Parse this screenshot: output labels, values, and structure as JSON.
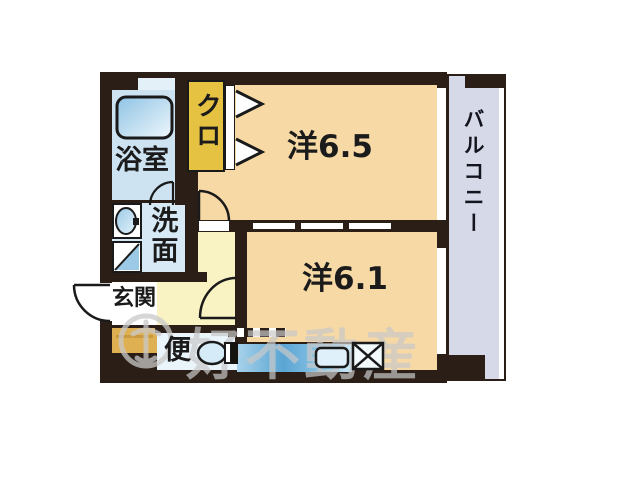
{
  "floorplan": {
    "rooms": {
      "bath": {
        "label": "浴室"
      },
      "closet": {
        "label": "クロ"
      },
      "western_65": {
        "label": "洋6.5"
      },
      "western_61": {
        "label": "洋6.1"
      },
      "washroom": {
        "label": "洗面"
      },
      "entrance": {
        "label": "玄関"
      },
      "toilet": {
        "label": "便"
      },
      "balcony": {
        "label": "バルコニー"
      }
    },
    "watermark": {
      "text": "好不動産",
      "logo": "realtor-logo-icon"
    },
    "fixtures": {
      "bathtub": "bathtub-icon",
      "wash_basin": "wash-basin-icon",
      "washing_machine": "washing-machine-icon",
      "toilet_bowl": "toilet-icon",
      "kitchen_sink": "kitchen-sink-icon",
      "refrigerator_space": "refrigerator-space-icon",
      "closet_doors": "folding-door-chevron-icon"
    },
    "colors": {
      "wall": "#2a1e17",
      "room_peach": "#f7d9a6",
      "hall_yellow": "#f9f3c3",
      "closet_gold": "#e6c242",
      "bath_blue": "#cde3f2",
      "bath_top_strip": "#e3f0f8",
      "washroom_blue": "#d6e9f5",
      "toilet_white_blue": "#eaf4fb",
      "balcony_lavender": "#d6dae8",
      "entrance_white": "#ffffff",
      "entrance_step_mustard": "#dfb052",
      "kitchen_blue": "#5aa5d4",
      "watermark_gray": "#c9c9c9"
    }
  }
}
